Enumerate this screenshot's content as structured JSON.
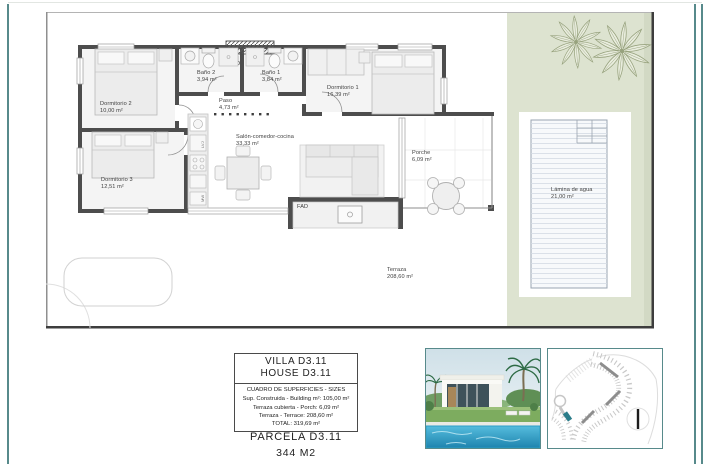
{
  "sheet": {
    "rooms": {
      "dormitorio2": {
        "name": "Dormitorio 2",
        "area": "10,00 m²"
      },
      "bano2": {
        "name": "Baño 2",
        "area": "3,94 m²"
      },
      "bano1": {
        "name": "Baño 1",
        "area": "3,84 m²"
      },
      "paso": {
        "name": "Paso",
        "area": "4,73 m²"
      },
      "dormitorio1": {
        "name": "Dormitorio 1",
        "area": "16,39 m²"
      },
      "salon": {
        "name": "Salón-comedor-cocina",
        "area": "33,33 m²"
      },
      "dormitorio3": {
        "name": "Dormitorio 3",
        "area": "12,51 m²"
      },
      "porche": {
        "name": "Porche",
        "area": "6,09 m²"
      },
      "terraza": {
        "name": "Terraza",
        "area": "208,60 m²"
      },
      "lamina": {
        "name": "Lámina de agua",
        "area": "21,00 m²"
      }
    },
    "annotations": {
      "fad": "FAD",
      "kitchen_top": "LVJ",
      "kitchen_bottom": "MW"
    }
  },
  "title_block": {
    "line1": "VILLA D3.11",
    "line2": "HOUSE D3.11",
    "table_title": "CUADRO DE SUPERFICIES  -  SIZES",
    "rows": [
      "Sup. Construida  -  Building m²:  105,00 m²",
      "Terraza cubierta  -  Porch:  6,09 m²",
      "Terraza  -  Terrace:  208,60 m²",
      "TOTAL:   319,69 m²"
    ],
    "parcela": "PARCELA D3.11",
    "parcel_area": "344 M2"
  },
  "colors": {
    "accent_teal": "#578a8b",
    "garden_green": "#dde3d0",
    "garden_shadow": "#d2d9c4",
    "wall_gray": "#4d4d4d",
    "pool_blue": "#2d9ec7"
  }
}
